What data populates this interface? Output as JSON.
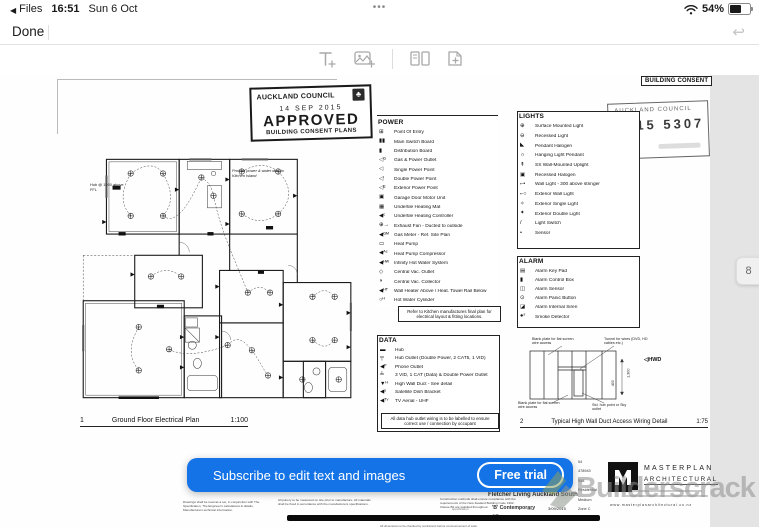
{
  "colors": {
    "banner_blue": "#1473e6",
    "chrome_gray": "#a8a8a8",
    "margin_gray": "#e4e4e4"
  },
  "status_bar": {
    "back_label": "Files",
    "time": "16:51",
    "date": "Sun 6 Oct",
    "multitask_dots": "•••",
    "battery_percent": "54%"
  },
  "nav": {
    "done_label": "Done"
  },
  "page_indicator": "8",
  "banner": {
    "message": "Subscribe to edit text and images",
    "cta": "Free trial"
  },
  "watermark": {
    "brand": "Builderscrack"
  },
  "doc": {
    "consent_tag": "BUILDING CONSENT",
    "approved_stamp": {
      "council": "AUCKLAND COUNCIL",
      "date": "14 SEP 2015",
      "word": "APPROVED",
      "line2": "BUILDING CONSENT PLANS"
    },
    "number_stamp": {
      "council": "AUCKLAND COUNCIL",
      "number": "2015 5307"
    },
    "plan_caption": {
      "num": "1",
      "title": "Ground Floor Electrical Plan",
      "scale": "1:100"
    },
    "plan_notes": {
      "hub": "Hub @ 1500 above FFL",
      "island": "Provide power & water duct to Kitchen Island"
    },
    "power": {
      "title": "POWER",
      "items": [
        {
          "glyph": "⊞",
          "label": "Point Of Entry"
        },
        {
          "glyph": "▮▮",
          "label": "Main Switch Board"
        },
        {
          "glyph": "▮",
          "label": "Distribution Board"
        },
        {
          "glyph": "◁ᴳ",
          "label": "Gas & Power Outlet"
        },
        {
          "glyph": "◁",
          "label": "Single Power Point"
        },
        {
          "glyph": "◁ʹ",
          "label": "Double Power Point"
        },
        {
          "glyph": "◁ᴱ",
          "label": "Exterior Power Point"
        },
        {
          "glyph": "▣",
          "label": "Garage Door Motor Unit"
        },
        {
          "glyph": "▦",
          "label": "Undertile Heating Mat"
        },
        {
          "glyph": "◀ᶜ",
          "label": "Undertile Heating Controller"
        },
        {
          "glyph": "⊕→",
          "label": "Exhaust Fan - Ducted to outside"
        },
        {
          "glyph": "◀ᴳᴹ",
          "label": "Gas Meter - Ref. Site Plan"
        },
        {
          "glyph": "▭",
          "label": "Heat Pump"
        },
        {
          "glyph": "◀ᴬᶜ",
          "label": "Heat Pump Compressor"
        },
        {
          "glyph": "◀ᴴᵂ",
          "label": "Infinity Hot Water System"
        },
        {
          "glyph": "◇",
          "label": "Central Vac. Outlet"
        },
        {
          "glyph": "◑",
          "label": "Central Vac. Collector"
        },
        {
          "glyph": "◀ᴴᵀ",
          "label": "Wall Heater Above / Heat. Towel Rail Below"
        },
        {
          "glyph": "○ᴴ",
          "label": "Hot Water Cylinder"
        }
      ],
      "note": "Refer to Kitchen manufactures final plan for electrical layout & fitting locations."
    },
    "lights": {
      "title": "LIGHTS",
      "items": [
        {
          "glyph": "⊕",
          "label": "Surface Mounted Light"
        },
        {
          "glyph": "⊖",
          "label": "Recessed Light"
        },
        {
          "glyph": "◣",
          "label": "Pendant Halogen"
        },
        {
          "glyph": "☼",
          "label": "Hanging Light Pendant"
        },
        {
          "glyph": "↟",
          "label": "SS Wall-Mounted Uplight"
        },
        {
          "glyph": "▣",
          "label": "Recessed Halogen"
        },
        {
          "glyph": "⌐•",
          "label": "Wall Light - 300 above stringer"
        },
        {
          "glyph": "⌐○",
          "label": "Exterior Wall Light"
        },
        {
          "glyph": "✧",
          "label": "Exterior Single Light"
        },
        {
          "glyph": "✦",
          "label": "Exterior Double Light"
        },
        {
          "glyph": "/",
          "label": "Light Switch"
        },
        {
          "glyph": "•",
          "label": "Sensor"
        }
      ]
    },
    "alarm": {
      "title": "ALARM",
      "items": [
        {
          "glyph": "▤",
          "label": "Alarm Key Pad"
        },
        {
          "glyph": "▮",
          "label": "Alarm Control Box"
        },
        {
          "glyph": "◫",
          "label": "Alarm Sensor"
        },
        {
          "glyph": "⊙",
          "label": "Alarm Panic Button"
        },
        {
          "glyph": "◪",
          "label": "Alarm Internal Siren"
        },
        {
          "glyph": "●ˢ",
          "label": "Smoke Detector"
        }
      ]
    },
    "data_legend": {
      "title": "DATA",
      "items": [
        {
          "glyph": "▬",
          "label": "Hub"
        },
        {
          "glyph": "╤",
          "label": "Hub Outlet (Double Power, 2 CAT5, 1 VID)"
        },
        {
          "glyph": "◀ᴾ",
          "label": "Phone Outlet"
        },
        {
          "glyph": "╧",
          "label": "3 VID, 1 CAT (Data) & Double Power Outlet"
        },
        {
          "glyph": "▼ᴴ",
          "label": "High Wall Duct - See detail"
        },
        {
          "glyph": "◀ˢ",
          "label": "Satellite Dish Bracket"
        },
        {
          "glyph": "◀ᵀᵛ",
          "label": "TV Aerial - UHF"
        }
      ],
      "note": "All data hub outlet wiring is to be labelled to ensure correct use / connection by occupant"
    },
    "detail_caption": {
      "num": "2",
      "title": "Typical High Wall Duct Access Wiring Detail",
      "scale": "1:75"
    },
    "detail_annotations": {
      "blank_top": "Blank plate for flat screen wire access",
      "tunnel": "Tunnel for wires (DVD, HD cables etc.)",
      "hwd": "◁HWD",
      "blank_bottom": "Blank plate for flat screen wire access",
      "hub_point": "Std. hub point or Sky outlet",
      "dim1": "1,300",
      "dim2": "400"
    },
    "title_block": {
      "fine_print_1": "Drawings shall be read as a set, in conjunction with The Specification, The Engineer's calculations & details, Manufacturers technical information.",
      "fine_print_2": "All joinery to be measured on site prior to manufacture. All materials shall be fixed in accordance with the manufacturers specifications.",
      "fine_print_3": "Construction methods shall ensure compliance with the requirements of the New Zealand Building Code 1992. Clause B2 are satisfied throughout.",
      "spec_label": "specification",
      "drawing_label": "drawing no.",
      "project": "Fletcher Living Auckland South",
      "design": "'B' Contemporary",
      "sheet": "87",
      "date_label": "date",
      "date": "3/09/2015",
      "job_label": "job no",
      "job": "888",
      "values": [
        "54",
        "478943",
        "558",
        "Residential",
        "Medium",
        "Zone C"
      ],
      "firm": {
        "name1": "MASTERPLAN",
        "name2": "ARCHITECTURAL",
        "web": "www.masterplanarchitectural.co.nz"
      },
      "footer": "All dimensions to be checked by contractors before commencement of work."
    }
  }
}
